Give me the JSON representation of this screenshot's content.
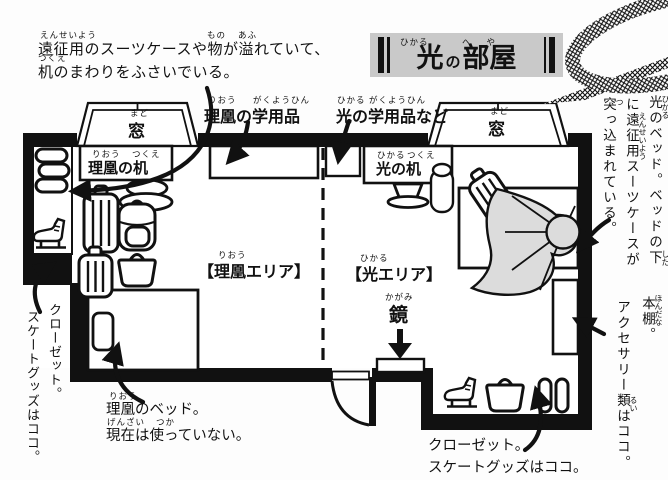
{
  "title": {
    "part1": "光",
    "part2": "の",
    "part3": "部屋",
    "furigana_hikaru": "ひかる",
    "furigana_heya": "へや"
  },
  "notes": {
    "top_left": {
      "line1": "遠征用のスーツケースや物が溢れていて、",
      "line2": "机のまわりをふさいでいる。",
      "furi_ensei": "えんせいよう",
      "furi_mono": "もの",
      "furi_afu": "あふ",
      "furi_tsukue": "つくえ"
    },
    "rio_bed": {
      "line1": "理凰のベッド。",
      "line2": "現在は使っていない。",
      "furi_riou": "りおう",
      "furi_genzai": "げんざい",
      "furi_tsuka": "つか"
    },
    "closet_bottom_right": {
      "line1": "クローゼット。",
      "line2": "スケートグッズはココ。"
    },
    "closet_left": {
      "col1": "クローゼット。",
      "col2": "スケートグッズはココ。"
    },
    "hikaru_bed": {
      "col1": "光のベッド。ベッドの下",
      "col2": "に遠征用スーツケースが",
      "col3": "突っ込まれている。",
      "furi_hikaru": "ひかる",
      "furi_shita": "した",
      "furi_ensei": "えんせいよう",
      "furi_tsu": "つ"
    },
    "bookshelf": {
      "col1": "本棚。",
      "col2": "アクセサリー類はココ。",
      "furi_hondana": "ほんだな",
      "furi_rui": "るい"
    }
  },
  "labels": {
    "rio_supplies": {
      "text": "理凰の学用品",
      "furi1": "りおう",
      "furi2": "がくようひん"
    },
    "hikaru_supplies": {
      "text": "光の学用品など",
      "furi1": "ひかる",
      "furi2": "がくようひん"
    },
    "window_left": {
      "text": "窓",
      "furi": "まど"
    },
    "window_right": {
      "text": "窓",
      "furi": "まど"
    },
    "rio_desk": {
      "text": "理凰の机",
      "furi1": "りおう",
      "furi2": "つくえ"
    },
    "hikaru_desk": {
      "text": "光の机",
      "furi1": "ひかる",
      "furi2": "つくえ"
    },
    "rio_area": {
      "text": "【理凰エリア】",
      "furi": "りおう"
    },
    "hikaru_area": {
      "text": "【光エリア】",
      "furi": "ひかる"
    },
    "mirror": {
      "text": "鏡",
      "furi": "かがみ"
    }
  },
  "colors": {
    "ink": "#111111",
    "banner_bg": "#c9c9c9",
    "blanket_gray": "#dcdcdc",
    "paper": "#fdfdfd"
  }
}
